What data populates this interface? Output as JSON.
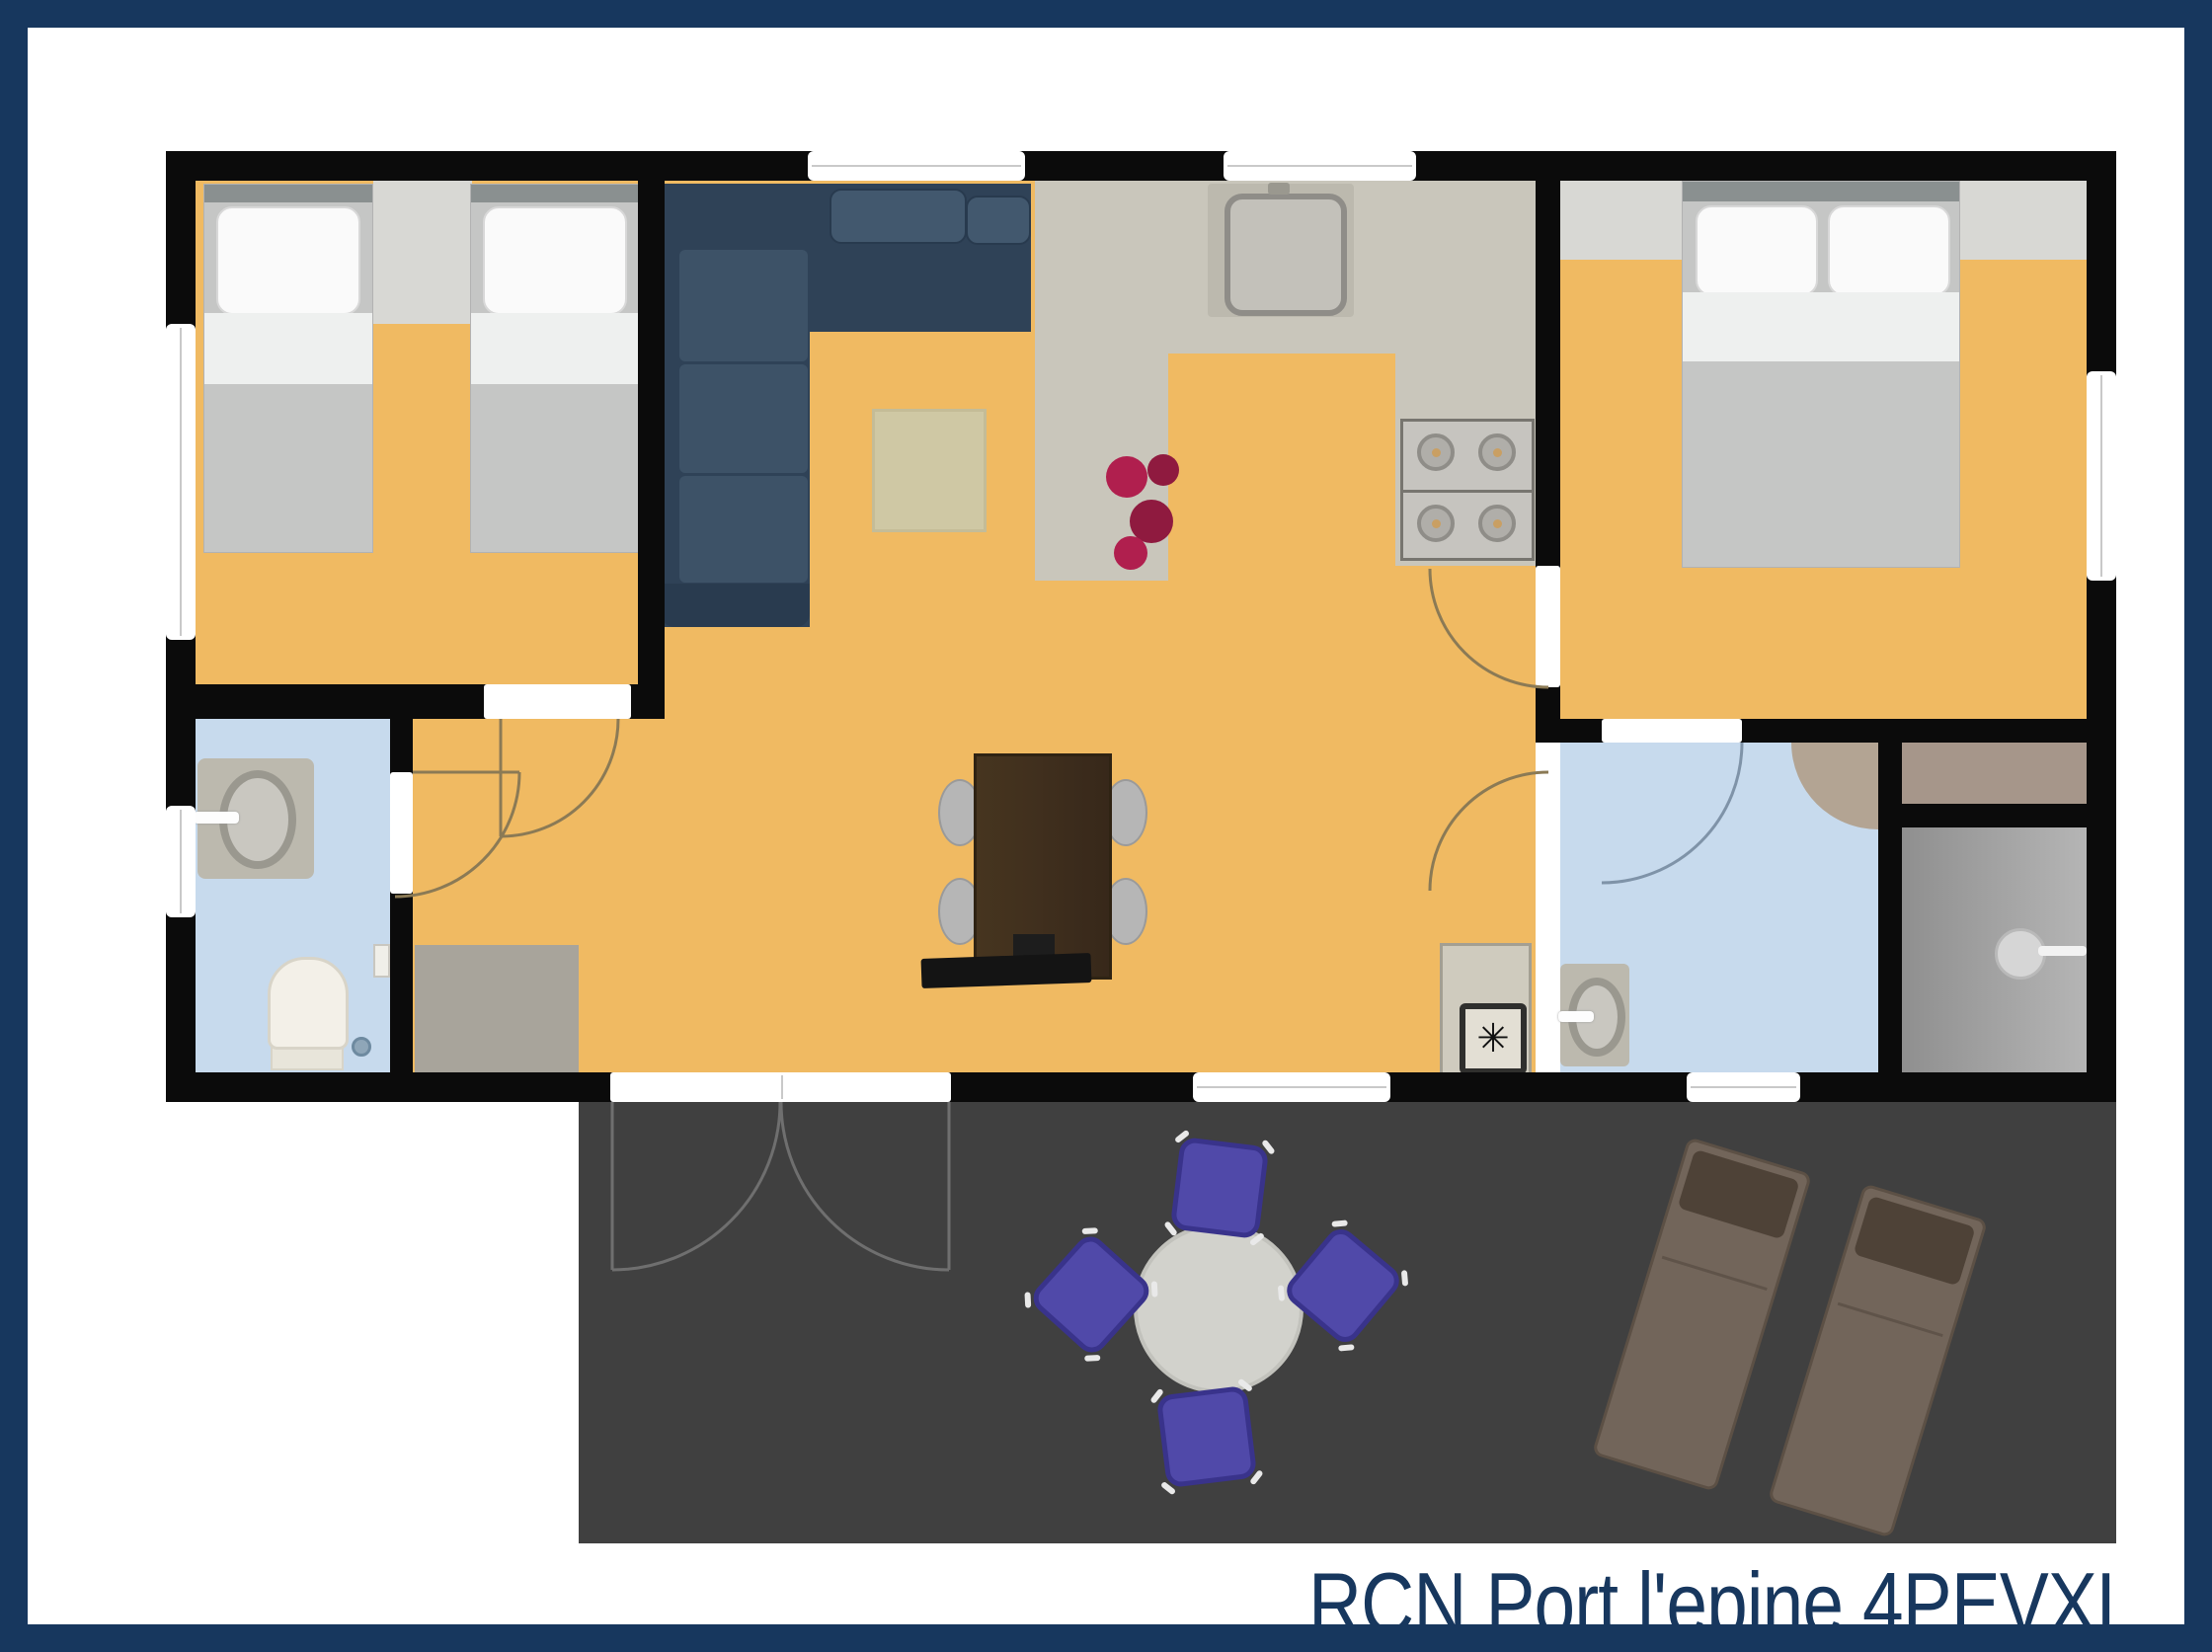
{
  "title": {
    "text": "RCN Port l'epine 4PEVXL"
  },
  "symbols": {
    "washer": "✳"
  },
  "colors": {
    "navy": "#17375e",
    "wall": "#0b0b0b",
    "floor": "#f0ba62",
    "kitchen": "#c9c6bb",
    "bath": "#c7daed",
    "terrace": "#404040",
    "counterPad": "#bcb9ae",
    "mat": "#a8a49b",
    "rug": "#cfc8a4",
    "rugBorder": "#c4bc97",
    "sofaBody": "#2f4257",
    "sofaCushion": "#3d5267",
    "sofaDark": "#293b4f",
    "sofaBolster": "#42586e",
    "bedBlanket": "#c5c6c5",
    "bedSheet": "#eef0ef",
    "pillow": "#fafafa",
    "pillowEdge": "#d8d8d8",
    "headboard": "#8a9090",
    "nightstand": "#d8d8d4",
    "tableWood": "#41301e",
    "tableWoodDark": "#2f2313",
    "chair": "#b6b6b6",
    "chairEdge": "#9a9a9a",
    "terraceTable": "#d2d2cc",
    "terraceChair": "#5049a9",
    "terraceChairEdge": "#39338b",
    "lounger": "#72655a",
    "loungerHead": "#4e4237",
    "loungerEdge": "#5c5045",
    "flower1": "#b01f4e",
    "flower2": "#8f1a3f",
    "closet": "#a6968a",
    "shower": "#9c9c9c",
    "showerLight": "#b5b5b5",
    "shelfTan": "#b3a493",
    "windowLine": "#c9c9c9",
    "doorArc": "#8b7a55",
    "applianceFace": "#c6c4bf",
    "applianceEdge": "#77756f",
    "burner": "#b0aea9",
    "burnerRing": "#8f8d88",
    "burnerDot": "#c99f63",
    "basinFill": "#c9c7c0",
    "basinRing": "#9a988f",
    "fixtureWhite": "#f3f0e8",
    "fixtureEdge": "#d8d4c8",
    "washerFace": "#cfcbbe",
    "washerEdge": "#a39f92",
    "white": "#ffffff"
  },
  "rooms": [
    {
      "name": "children-bedroom",
      "floor": "yellow"
    },
    {
      "name": "living-dining-room",
      "floor": "yellow"
    },
    {
      "name": "kitchen",
      "floor": "gray"
    },
    {
      "name": "hallway",
      "floor": "yellow"
    },
    {
      "name": "toilet-bathroom-left",
      "floor": "blue"
    },
    {
      "name": "master-bedroom",
      "floor": "yellow"
    },
    {
      "name": "bathroom-right",
      "floor": "blue"
    },
    {
      "name": "shower-room",
      "floor": "gray"
    },
    {
      "name": "closet",
      "floor": "tan"
    },
    {
      "name": "terrace",
      "floor": "dark-gray"
    }
  ],
  "furniture": [
    "single-bed x2",
    "nightstand",
    "corner-sofa",
    "rug",
    "flower-decoration",
    "kitchen-sink",
    "stove-4-burners",
    "kitchen-counter",
    "dining-table",
    "dining-chair x4",
    "tv-sideboard",
    "washing-machine",
    "double-bed",
    "bedside-shelf x2",
    "wash-basin x2",
    "toilet",
    "shower-head",
    "corner-shelf",
    "doormat",
    "terrace-round-table",
    "terrace-chair x4",
    "sun-lounger x2",
    "front-double-door",
    "interior-door x5",
    "window x7"
  ]
}
